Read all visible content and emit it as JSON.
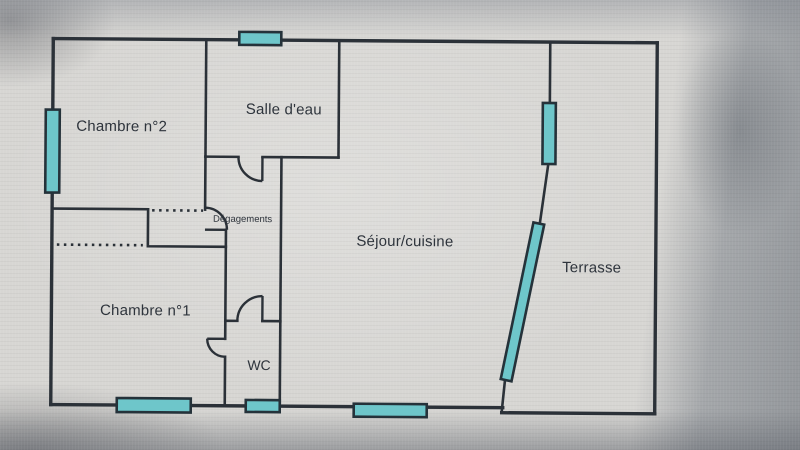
{
  "rooms": {
    "chambre2": {
      "label": "Chambre n°2"
    },
    "salle_deau": {
      "label": "Salle d'eau"
    },
    "degagements": {
      "label": "Dégagements"
    },
    "chambre1": {
      "label": "Chambre n°1"
    },
    "wc": {
      "label": "WC"
    },
    "sejour_cuisine": {
      "label": "Séjour/cuisine"
    },
    "terrasse": {
      "label": "Terrasse"
    }
  },
  "colors": {
    "wall": "#2b3138",
    "ink": "#2e343c",
    "window_fill": "#6ec6ca",
    "window_border": "#25323a",
    "paper": "#d7d6d3"
  }
}
